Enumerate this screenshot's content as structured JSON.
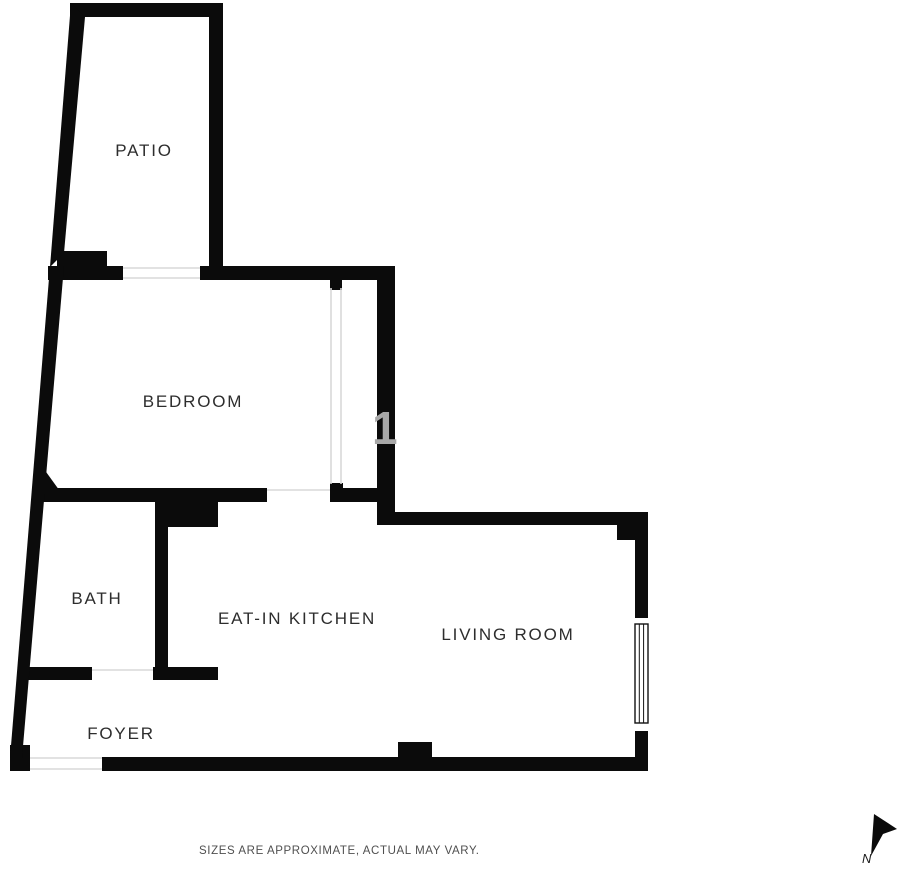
{
  "plan": {
    "colors": {
      "background": "#ffffff",
      "wall": "#0b0b0b",
      "opening_line": "#d8d8d8",
      "window_frame": "#111111",
      "label": "#2d2d2d"
    },
    "rooms": [
      {
        "id": "patio",
        "label": "PATIO",
        "cx": 144,
        "cy": 151
      },
      {
        "id": "bedroom",
        "label": "BEDROOM",
        "cx": 193,
        "cy": 402
      },
      {
        "id": "bath",
        "label": "BATH",
        "cx": 97,
        "cy": 599
      },
      {
        "id": "kitchen",
        "label": "EAT-IN KITCHEN",
        "cx": 297,
        "cy": 619
      },
      {
        "id": "living",
        "label": "LIVING ROOM",
        "cx": 508,
        "cy": 635
      },
      {
        "id": "foyer",
        "label": "FOYER",
        "cx": 121,
        "cy": 734
      }
    ],
    "walls": {
      "rects": [
        {
          "name": "patio-top-wall",
          "x": 70,
          "y": 3,
          "w": 153,
          "h": 14
        },
        {
          "name": "patio-right-wall",
          "x": 209,
          "y": 3,
          "w": 14,
          "h": 277
        },
        {
          "name": "patio-step",
          "x": 57,
          "y": 251,
          "w": 50,
          "h": 16
        },
        {
          "name": "bedroom-top-wall-left",
          "x": 48,
          "y": 266,
          "w": 75,
          "h": 14
        },
        {
          "name": "bedroom-top-wall-right",
          "x": 200,
          "y": 266,
          "w": 195,
          "h": 14
        },
        {
          "name": "bedroom-right-heavy-wall",
          "x": 377,
          "y": 266,
          "w": 18,
          "h": 259
        },
        {
          "name": "partition-top-cap",
          "x": 330,
          "y": 277,
          "w": 12,
          "h": 13
        },
        {
          "name": "partition-bottom-cap",
          "x": 330,
          "y": 483,
          "w": 13,
          "h": 18
        },
        {
          "name": "bedroom-bottom-wall",
          "x": 42,
          "y": 488,
          "w": 225,
          "h": 14
        },
        {
          "name": "bedroom-bottom-wall-right",
          "x": 330,
          "y": 488,
          "w": 65,
          "h": 14
        },
        {
          "name": "kitchen-corner-block",
          "x": 158,
          "y": 500,
          "w": 60,
          "h": 27
        },
        {
          "name": "bath-kitchen-divider",
          "x": 155,
          "y": 502,
          "w": 13,
          "h": 177
        },
        {
          "name": "bath-bottom-wall-left",
          "x": 27,
          "y": 667,
          "w": 65,
          "h": 13
        },
        {
          "name": "bath-bottom-wall-right",
          "x": 153,
          "y": 667,
          "w": 65,
          "h": 13
        },
        {
          "name": "living-top-wall",
          "x": 377,
          "y": 512,
          "w": 271,
          "h": 13
        },
        {
          "name": "living-corner-block",
          "x": 617,
          "y": 525,
          "w": 31,
          "h": 15
        },
        {
          "name": "right-wall-above-window",
          "x": 635,
          "y": 512,
          "w": 13,
          "h": 106
        },
        {
          "name": "right-wall-below-window",
          "x": 635,
          "y": 731,
          "w": 13,
          "h": 40
        },
        {
          "name": "bottom-wall",
          "x": 102,
          "y": 757,
          "w": 546,
          "h": 14
        },
        {
          "name": "bottom-wall-bump",
          "x": 398,
          "y": 742,
          "w": 34,
          "h": 15
        },
        {
          "name": "left-wall-foot",
          "x": 10,
          "y": 745,
          "w": 20,
          "h": 26
        }
      ],
      "polygons": [
        {
          "name": "patio-left-wall",
          "points": "71,3 85,17 64,253 50,267"
        },
        {
          "name": "left-wall",
          "points": "50,266 64,266 22,758 10,758"
        },
        {
          "name": "left-wall-chamfer",
          "points": "36,458 62,494 36,494"
        },
        {
          "name": "north-arrow",
          "points": "874,814 897,829 883,834 871,856"
        }
      ]
    },
    "openings": [
      {
        "name": "patio-door-top",
        "x1": 123,
        "y1": 268,
        "x2": 200,
        "y2": 268
      },
      {
        "name": "patio-door-bottom",
        "x1": 123,
        "y1": 278,
        "x2": 200,
        "y2": 278
      },
      {
        "name": "partition-line-left",
        "x1": 331,
        "y1": 288,
        "x2": 331,
        "y2": 484
      },
      {
        "name": "partition-line-right",
        "x1": 341,
        "y1": 288,
        "x2": 341,
        "y2": 484
      },
      {
        "name": "bedroom-kitchen-opening",
        "x1": 267,
        "y1": 490,
        "x2": 330,
        "y2": 490
      },
      {
        "name": "bath-door",
        "x1": 92,
        "y1": 670,
        "x2": 153,
        "y2": 670
      },
      {
        "name": "entry-door-top",
        "x1": 30,
        "y1": 758,
        "x2": 102,
        "y2": 758
      },
      {
        "name": "entry-door-bottom",
        "x1": 30,
        "y1": 769,
        "x2": 102,
        "y2": 769
      }
    ],
    "window": {
      "frame": {
        "x": 635,
        "y": 624,
        "w": 13,
        "h": 99
      },
      "mullions": [
        639.3,
        643.6
      ]
    },
    "watermark": {
      "text": "1"
    },
    "disclaimer": {
      "text": "SIZES ARE APPROXIMATE, ACTUAL MAY VARY."
    },
    "north": {
      "label": "N"
    }
  }
}
